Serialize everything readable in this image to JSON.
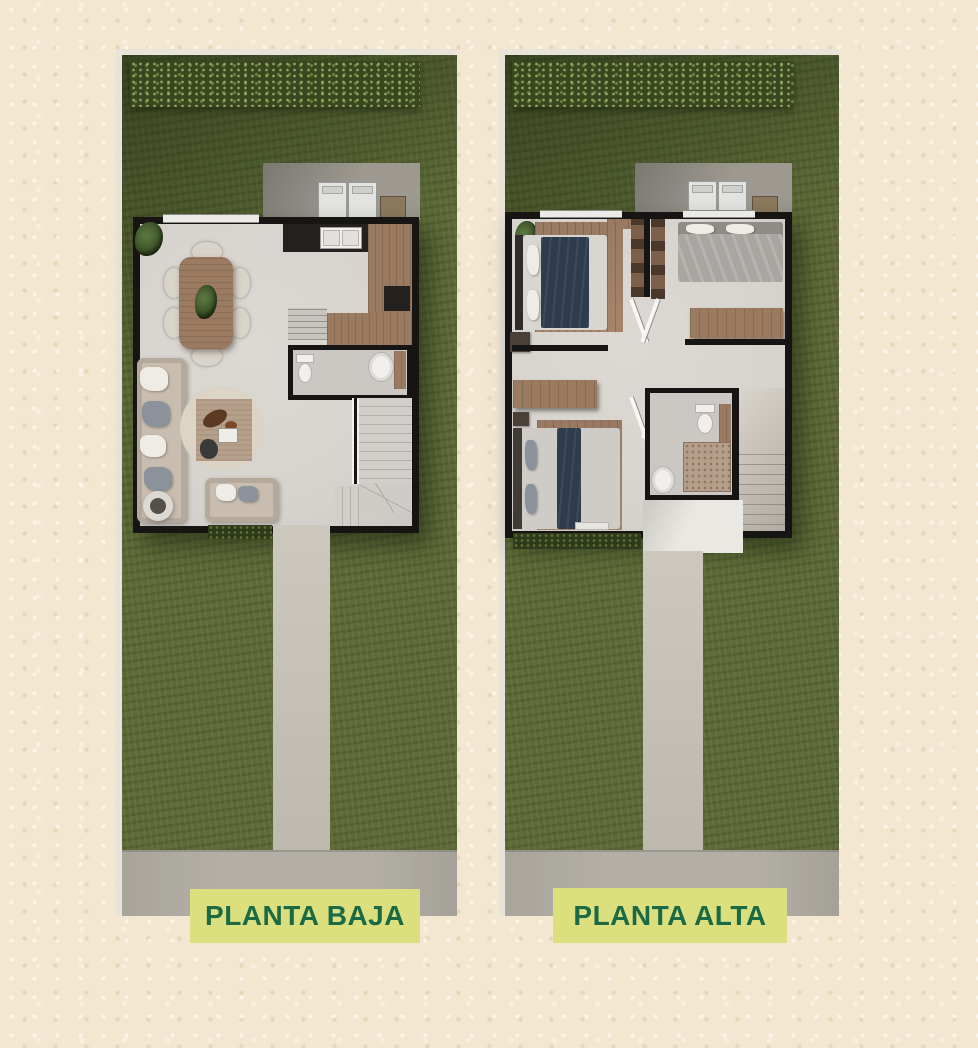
{
  "panels": [
    {
      "id": "planta-baja",
      "label": "PLANTA BAJA",
      "items": [
        "lawn",
        "hedge-row",
        "laundry-patio",
        "washer",
        "dryer",
        "water-heater",
        "dining-table",
        "dining-chairs",
        "kitchen-counter",
        "kitchen-sink",
        "stove",
        "pantry-steps",
        "half-bathroom",
        "toilet",
        "lavatory",
        "sectional-sofa",
        "loveseat",
        "round-rug",
        "accent-rug",
        "coffee-table-decor",
        "side-table",
        "staircase",
        "entry-walkway",
        "sidewalk"
      ]
    },
    {
      "id": "planta-alta",
      "label": "PLANTA ALTA",
      "items": [
        "lawn",
        "hedge-row",
        "laundry-patio",
        "washer",
        "dryer",
        "water-heater",
        "bedroom-1-bed",
        "bedroom-2-bed",
        "bedroom-3-bed",
        "closets",
        "dressers",
        "hallway-doors",
        "bathroom",
        "toilet",
        "shower",
        "lavatory",
        "staircase",
        "porch",
        "entry-walkway",
        "sidewalk"
      ]
    }
  ],
  "colors": {
    "page_bg": "#f3e7d1",
    "frame": "#e8e4da",
    "grass": "#5d6a37",
    "grass_shadow": "#3e4b25",
    "hedge": "#39471f",
    "patio": "#9d9991",
    "walkway": "#c6c2b8",
    "sidewalk": "#b3afa6",
    "wall": "#171513",
    "floor": "#d6d2cd",
    "wood": "#9a7a61",
    "wood_dark": "#7c5f4a",
    "counter_dark": "#23211f",
    "sofa": "#c8bdaf",
    "rug_round": "#dbd3c3",
    "rug_square": "#b5a08c",
    "bed_navy": "#2e3c4d",
    "bed_gray": "#a9a5a1",
    "tile": "#b59e89",
    "porch": "#eae8e2",
    "stair": "#d2cfca",
    "label_bg": "#dbdf7d",
    "label_text": "#1a6a45",
    "white_goods": "#e3e3e1",
    "fixture": "#f0efeb"
  }
}
